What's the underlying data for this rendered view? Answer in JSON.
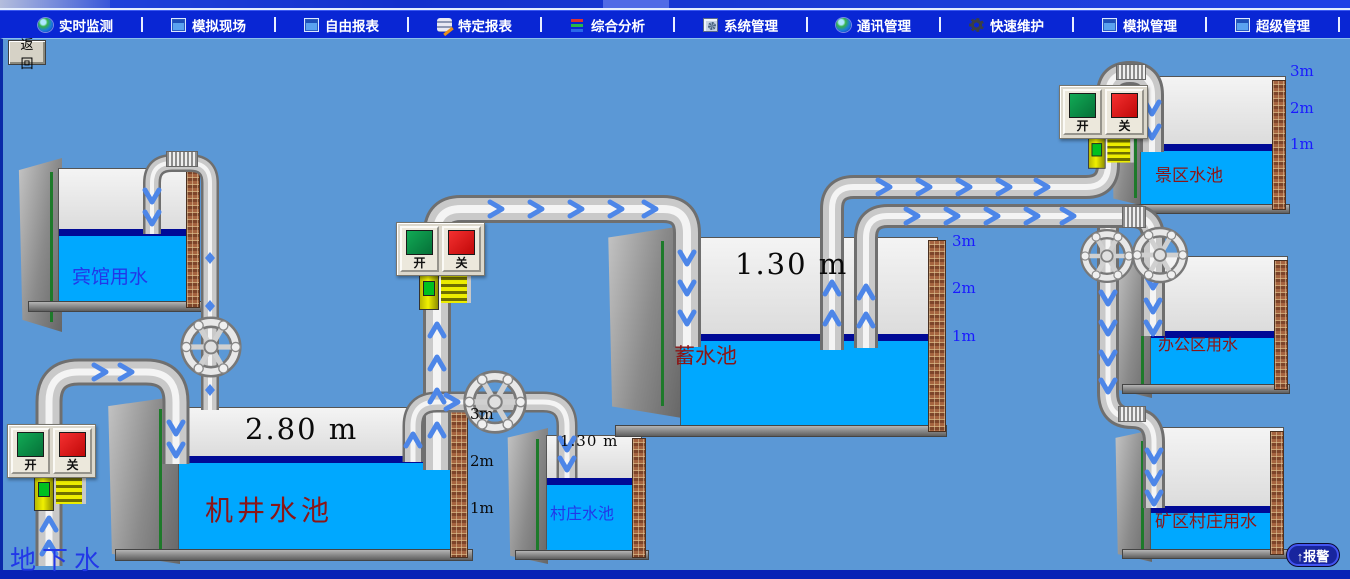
{
  "menu": {
    "items": [
      {
        "label": "实时监测",
        "icon": "globe-monitor-icon"
      },
      {
        "label": "模拟现场",
        "icon": "window-icon"
      },
      {
        "label": "自由报表",
        "icon": "window-icon"
      },
      {
        "label": "特定报表",
        "icon": "report-pencil-icon"
      },
      {
        "label": "综合分析",
        "icon": "bar-chart-icon"
      },
      {
        "label": "系统管理",
        "icon": "system-window-icon"
      },
      {
        "label": "通讯管理",
        "icon": "globe-icon"
      },
      {
        "label": "快速维护",
        "icon": "gear-icon"
      },
      {
        "label": "模拟管理",
        "icon": "window-icon"
      },
      {
        "label": "超级管理",
        "icon": "window-icon"
      }
    ]
  },
  "back_button": {
    "label": "返回"
  },
  "alarm_button": {
    "label": "↑报警"
  },
  "switch_labels": {
    "on": "开",
    "off": "关"
  },
  "groundwater_label": "地下水",
  "tanks": {
    "hotel": {
      "name": "宾馆用水"
    },
    "well": {
      "name": "机井水池",
      "level": "2.80 m",
      "scale": [
        "3m",
        "2m",
        "1m"
      ]
    },
    "village": {
      "name": "村庄水池",
      "level": "1.30 m"
    },
    "reservoir": {
      "name": "蓄水池",
      "level": "1.30 m",
      "scale": [
        "3m",
        "2m",
        "1m"
      ]
    },
    "scenic": {
      "name": "景区水池",
      "scale": [
        "3m",
        "2m",
        "1m"
      ]
    },
    "office": {
      "name": "办公区用水"
    },
    "mine": {
      "name": "矿区村庄用水"
    }
  },
  "colors": {
    "canvas": "#5b98d6",
    "menu_bar": "#0926d4",
    "water": "#00a8ff",
    "waterline": "#000a96",
    "flow_arrow": "#4d86e8",
    "on_green": "#0a9648",
    "off_red": "#e41414",
    "label_red": "#8b1616",
    "label_blue": "#2238e8"
  }
}
